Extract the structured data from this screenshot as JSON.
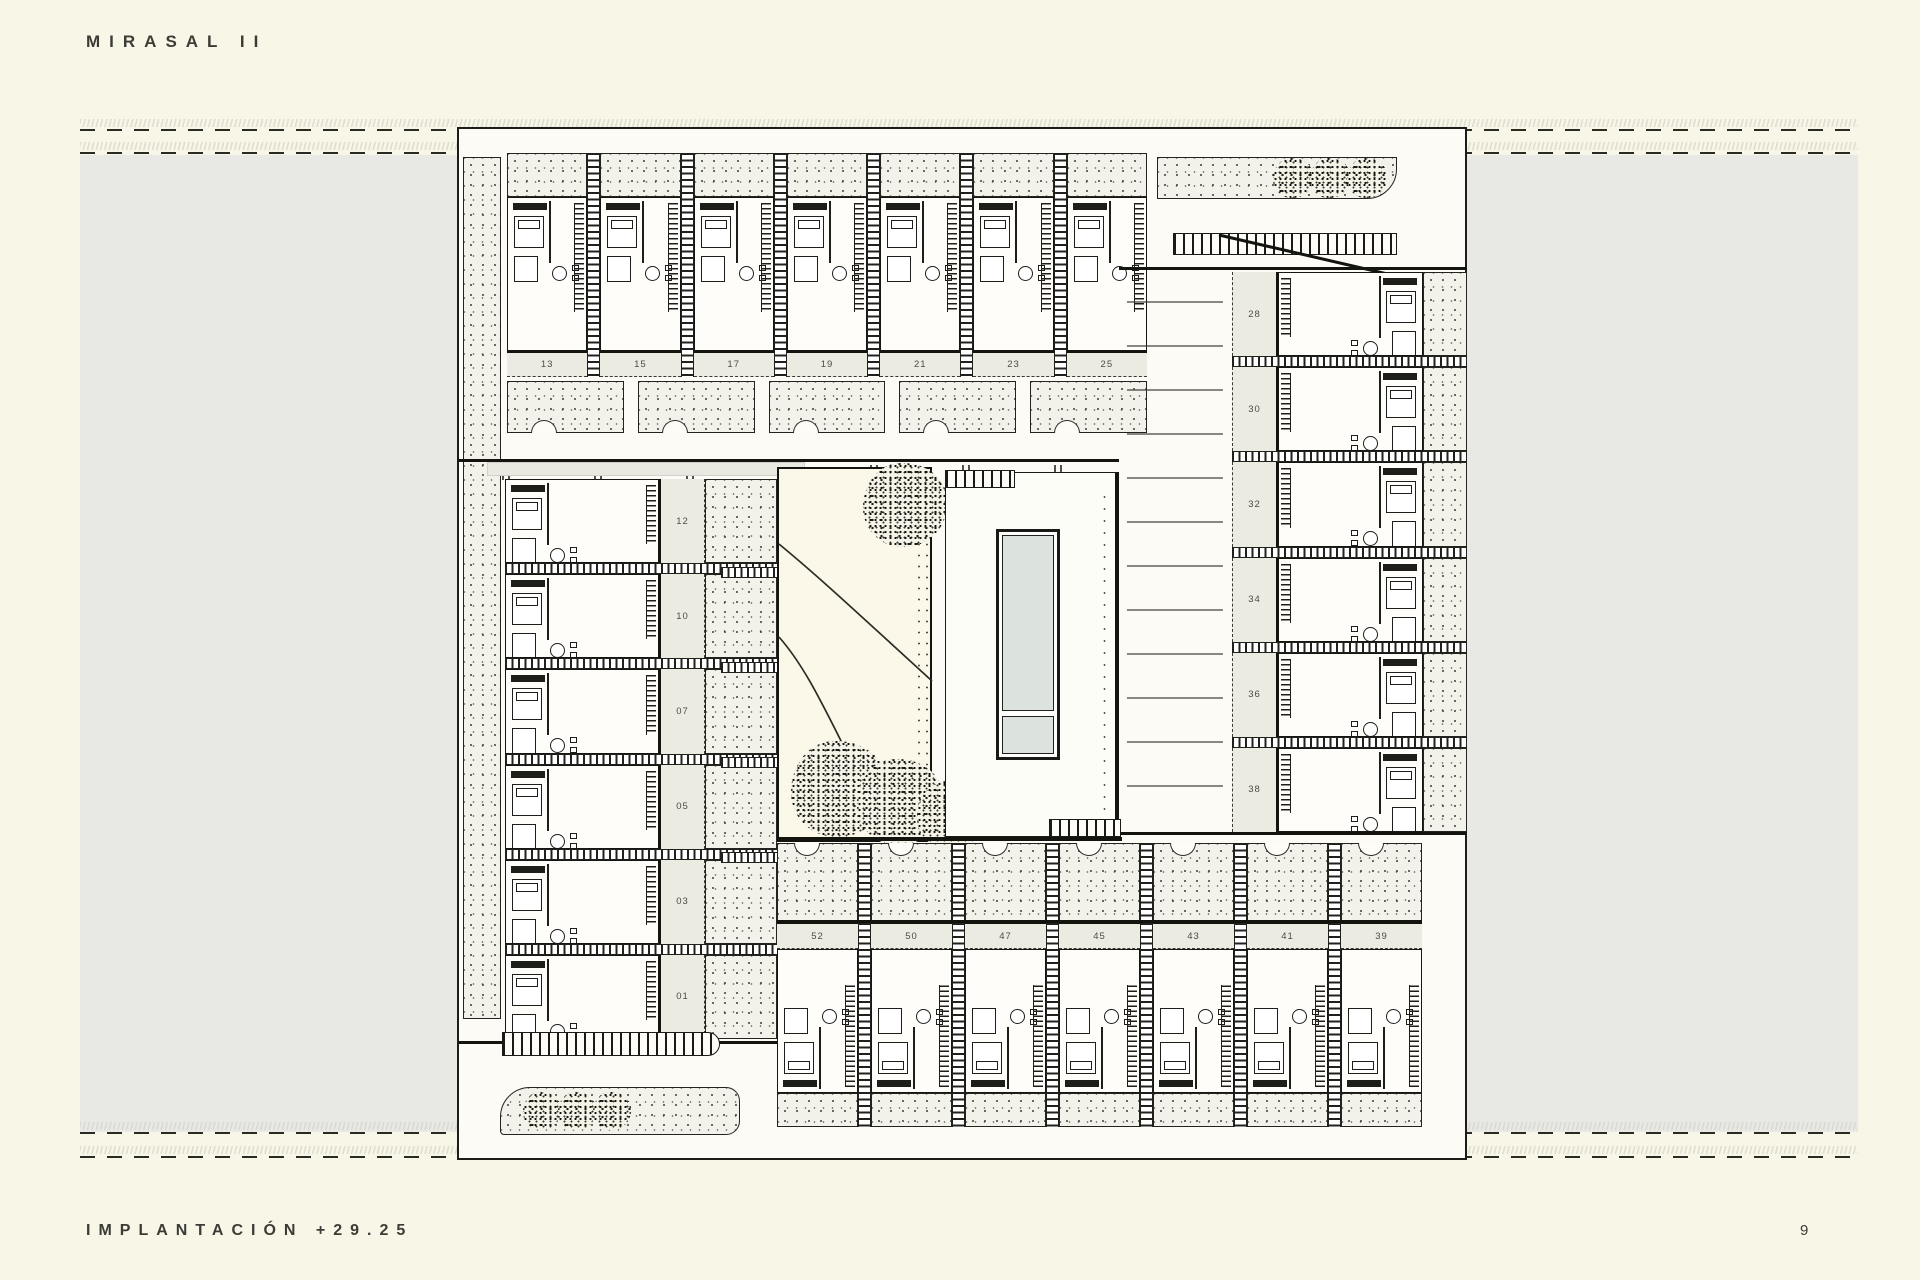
{
  "page": {
    "title": "MIRASAL II",
    "caption": "IMPLANTACIÓN +29.25",
    "page_number": "9"
  },
  "colors": {
    "background": "#f8f6e7",
    "side_panels": "#e8e8e4",
    "paper": "#fcfbf6",
    "number_band": "#ecebe2",
    "pool_water": "#dce3df",
    "line_ink": "#1c1c19"
  },
  "plan": {
    "units": {
      "top": [
        "13",
        "15",
        "17",
        "19",
        "21",
        "23",
        "25"
      ],
      "left": [
        "12",
        "10",
        "07",
        "05",
        "03",
        "01"
      ],
      "right": [
        "28",
        "30",
        "32",
        "34",
        "36",
        "38"
      ],
      "bottom": [
        "52",
        "50",
        "47",
        "45",
        "43",
        "41",
        "39"
      ]
    },
    "feature_names": [
      "courtyard-garden",
      "swimming-pool",
      "pool-deck",
      "pergolas",
      "tree-beds",
      "parking-road"
    ]
  }
}
